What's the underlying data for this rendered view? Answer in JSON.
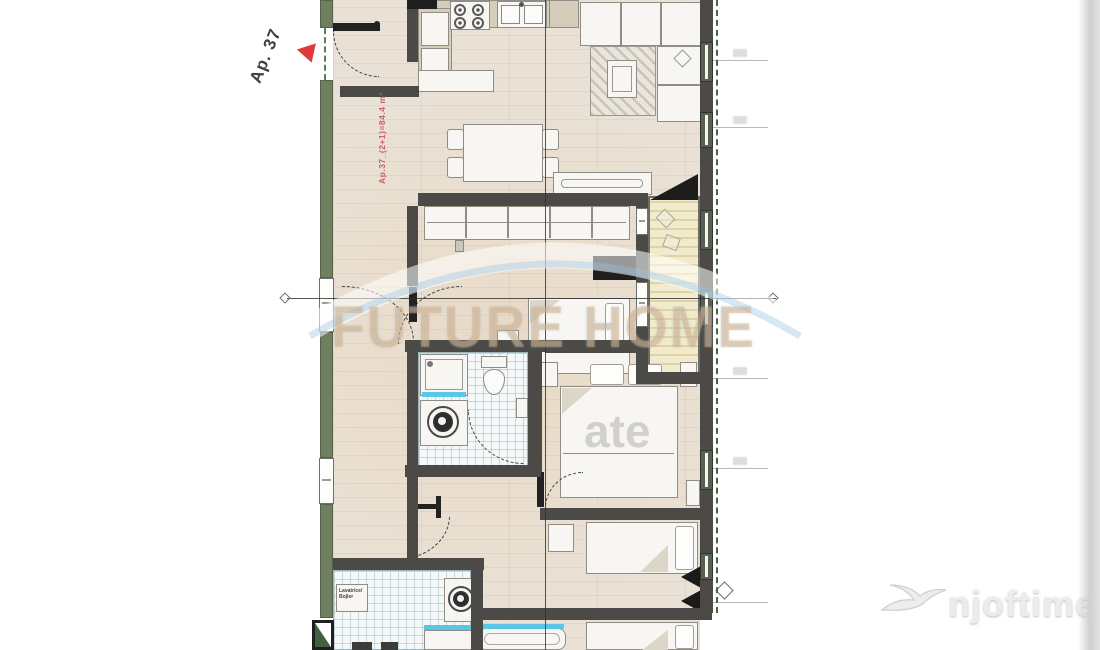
{
  "plan": {
    "marker_label": "Ap. 37",
    "area_label": "Ap.37_(2+1)=84.4 m²",
    "utility_label_line1": "Lavatrice/",
    "utility_label_line2": "Bojler"
  },
  "watermarks": {
    "brand": "FUTURE HOME",
    "brand_fragment": "ate",
    "site_logo": "njoftime.al"
  },
  "icons": {
    "marker_pin": "red-triangle-pin",
    "site_bird": "swallow-icon",
    "stove": "four-burner-stove-icon",
    "sink": "double-sink-icon",
    "washing_machine": "washing-machine-icon",
    "toilet": "toilet-icon",
    "shower": "shower-icon",
    "bathtub": "bathtub-icon"
  },
  "colors": {
    "wall": "#4b4a46",
    "exterior_wall_green": "#6f7f5f",
    "floor_wood": "#e8e0d4",
    "balcony_floor": "#efe8c8",
    "tile": "#f5f8f8",
    "accent_red": "#e03b3b",
    "area_text_red": "#c7525c",
    "water_blue": "#59c6e6",
    "watermark_orange": "#e8a65e",
    "boundary_green": "#46663f"
  }
}
